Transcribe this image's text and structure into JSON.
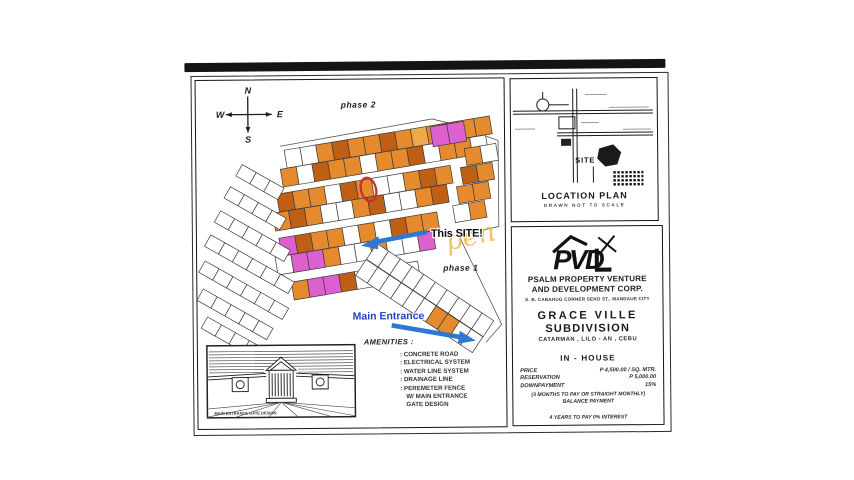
{
  "flyer": {
    "map": {
      "compass": {
        "n": "N",
        "e": "E",
        "w": "W",
        "s": "S"
      },
      "phase2_label": "phase 2",
      "phase1_label": "phase 1",
      "site_annotation": "This SITE!",
      "pen_watermark": "pen",
      "entrance_annotation": "Main Entrance",
      "annotation_blue": "#2e78cf",
      "highlight_red": "#c92e2e",
      "lot_palette": {
        "O": "#e68a2e",
        "D": "#bf5f16",
        "M": "#de5fce",
        "W": "#ffffff",
        "Y": "#efa94d"
      },
      "lot_strips": [
        {
          "x": 88,
          "y": 70,
          "a": -9,
          "w": 16,
          "h": 18,
          "c": "WWODOODOYODOO"
        },
        {
          "x": 84,
          "y": 89,
          "a": -9,
          "w": 16,
          "h": 18,
          "c": "OWDOOWOODWOOW"
        },
        {
          "x": 80,
          "y": 114,
          "a": -9,
          "w": 16,
          "h": 18,
          "c": "DOOWDOWWODO"
        },
        {
          "x": 76,
          "y": 133,
          "a": -9,
          "w": 16,
          "h": 18,
          "c": "ODOWWODWWOD"
        },
        {
          "x": 82,
          "y": 158,
          "a": -9,
          "w": 16,
          "h": 18,
          "c": "MDOOWOWDOO"
        },
        {
          "x": 78,
          "y": 177,
          "a": -9,
          "w": 16,
          "h": 18,
          "c": "WMMOWWOWWM"
        },
        {
          "x": 94,
          "y": 202,
          "a": -9,
          "w": 16,
          "h": 18,
          "c": "OMMDWOWW"
        },
        {
          "x": 234,
          "y": 48,
          "a": -9,
          "w": 17,
          "h": 20,
          "c": "MM"
        },
        {
          "x": 268,
          "y": 70,
          "a": -9,
          "w": 16,
          "h": 17,
          "c": "OW"
        },
        {
          "x": 264,
          "y": 89,
          "a": -9,
          "w": 16,
          "h": 17,
          "c": "DO"
        },
        {
          "x": 260,
          "y": 108,
          "a": -9,
          "w": 16,
          "h": 17,
          "c": "OO"
        },
        {
          "x": 256,
          "y": 127,
          "a": -9,
          "w": 16,
          "h": 17,
          "c": "WO"
        },
        {
          "x": 46,
          "y": 84,
          "a": 30,
          "w": 16,
          "h": 13,
          "c": "WWW"
        },
        {
          "x": 34,
          "y": 106,
          "a": 30,
          "w": 16,
          "h": 13,
          "c": "WWWW"
        },
        {
          "x": 24,
          "y": 130,
          "a": 30,
          "w": 16,
          "h": 13,
          "c": "WWWWW"
        },
        {
          "x": 14,
          "y": 154,
          "a": 30,
          "w": 16,
          "h": 13,
          "c": "WWWWWW"
        },
        {
          "x": 8,
          "y": 180,
          "a": 30,
          "w": 16,
          "h": 13,
          "c": "WWWWWW"
        },
        {
          "x": 6,
          "y": 208,
          "a": 30,
          "w": 16,
          "h": 13,
          "c": "WWWWW"
        },
        {
          "x": 10,
          "y": 236,
          "a": 30,
          "w": 16,
          "h": 13,
          "c": "WWWW"
        },
        {
          "x": 180,
          "y": 164,
          "a": 34,
          "w": 14,
          "h": 19,
          "c": "WWWWWWWWWW"
        },
        {
          "x": 169,
          "y": 180,
          "a": 34,
          "w": 14,
          "h": 19,
          "c": "WWWWWWOOWW"
        }
      ]
    },
    "location_plan": {
      "site_label": "SITE",
      "title": "LOCATION PLAN",
      "subtitle": "DRAWN NOT TO SCALE"
    },
    "company": {
      "logo_text": "PVD",
      "name_line1": "PSALM PROPERTY VENTURE",
      "name_line2": "AND DEVELOPMENT CORP.",
      "address": "S. B. CABAHUG CORNER SENO ST., MANDAUE CITY"
    },
    "project": {
      "name_line1": "GRACE VILLE",
      "name_line2": "SUBDIVISION",
      "location": "CATARMAN , LILO - AN , CEBU"
    },
    "financing": {
      "header": "IN - HOUSE",
      "rows": [
        [
          "PRICE",
          "P 4,500.00 / SQ. MTR."
        ],
        [
          "RESERVATION",
          "P 5,000.00"
        ],
        [
          "DOWNPAYMENT",
          "15%"
        ]
      ],
      "note1": "(3 MONTHS TO PAY OR STRAIGHT MONTHLY)",
      "note2": "BALANCE PAYMENT",
      "note3": "4 YEARS TO PAY 0% INTEREST"
    },
    "amenities": {
      "header": "AMENITIES :",
      "lines": [
        ": CONCRETE ROAD",
        ": ELECTRICAL SYSTEM",
        ": WATER LINE SYSTEM",
        ": DRAINAGE LINE",
        ": PEREMETER FENCE",
        "W/ MAIN ENTRANCE",
        "GATE DESIGN"
      ]
    },
    "gate": {
      "caption": "MAIN ENTRANCE GATE DESIGN"
    }
  }
}
